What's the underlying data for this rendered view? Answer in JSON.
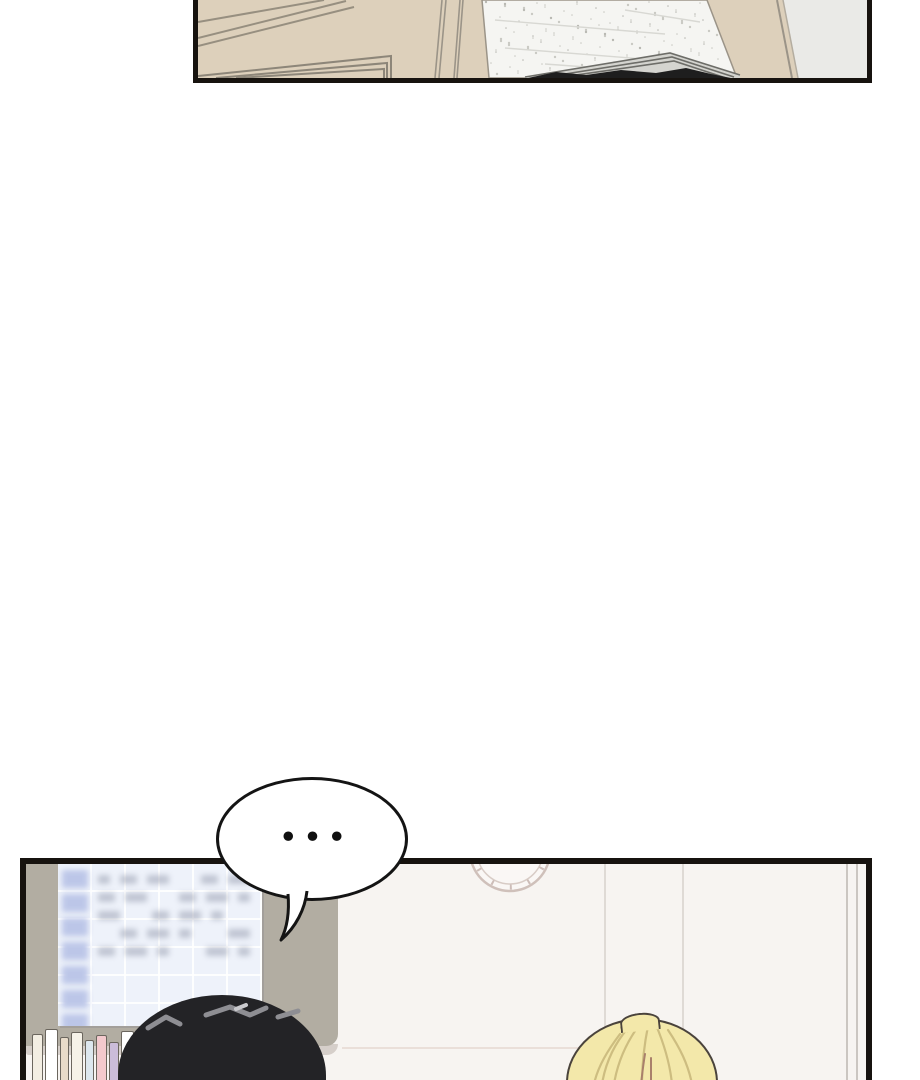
{
  "page": {
    "width": 920,
    "height": 1080,
    "kind": "webtoon-comic-page",
    "panel_count": 2
  },
  "speech_bubble": {
    "text": "•••",
    "shape": "ellipse",
    "tail_direction": "down-left"
  },
  "colors": {
    "page-bg": "#ffffff",
    "ink": "#17130f",
    "ink2": "#141414",
    "beige": "#ddd0bb",
    "ceiling-white": "#f5f5f2",
    "right-gray": "#eaeae7",
    "trim-line": "#978f80",
    "panel-bg": "#f7f4f1",
    "wall-gray": "#b2ada2",
    "tray": "#d6cfca",
    "board-bg": "#eef2fa",
    "board-header": "#bcc6e8",
    "dark-hair": "#232326",
    "dark-hair-highlight": "#8e8e93",
    "blonde": "#f3e8aa",
    "blonde-strand": "#cdbd80",
    "blonde-outline": "#4a433c",
    "clock-line": "#cfc0ba",
    "bubble-fill": "#ffffff",
    "faint-line": "#dfdad5",
    "frame-line": "#cbc6c1"
  },
  "top_panel": {
    "content": "beige ceiling corner with trim, speckled white ceiling section, beige pillar, gray wall"
  },
  "bottom_panel": {
    "content": "classroom wall: blurred timetable board on gray wall, wall clock, bookshelf spines, two heads",
    "board": {
      "header_cells": 7,
      "text_rows": 5,
      "text_cols": 6
    },
    "books": [
      {
        "x": 4,
        "w": 11,
        "h": 58,
        "c": "#f3eee3"
      },
      {
        "x": 17,
        "w": 13,
        "h": 63,
        "c": "#ffffff"
      },
      {
        "x": 32,
        "w": 9,
        "h": 55,
        "c": "#e8dbc9"
      },
      {
        "x": 43,
        "w": 12,
        "h": 60,
        "c": "#f6f2e8"
      },
      {
        "x": 57,
        "w": 9,
        "h": 52,
        "c": "#dde7ee"
      },
      {
        "x": 68,
        "w": 11,
        "h": 57,
        "c": "#f3c9cd"
      },
      {
        "x": 81,
        "w": 10,
        "h": 50,
        "c": "#cbbcd9"
      },
      {
        "x": 93,
        "w": 13,
        "h": 61,
        "c": "#ffffff"
      },
      {
        "x": 108,
        "w": 9,
        "h": 54,
        "c": "#cfe1eb"
      },
      {
        "x": 119,
        "w": 11,
        "h": 59,
        "c": "#f4eee0"
      },
      {
        "x": 132,
        "w": 9,
        "h": 51,
        "c": "#e9a9b0"
      },
      {
        "x": 143,
        "w": 12,
        "h": 63,
        "c": "#f7f4ec"
      },
      {
        "x": 157,
        "w": 9,
        "h": 53,
        "c": "#e9bcc2"
      },
      {
        "x": 168,
        "w": 11,
        "h": 58,
        "c": "#e6d9c6"
      },
      {
        "x": 181,
        "w": 10,
        "h": 50,
        "c": "#f0c6ca"
      },
      {
        "x": 193,
        "w": 12,
        "h": 60,
        "c": "#ffffff"
      },
      {
        "x": 207,
        "w": 9,
        "h": 54,
        "c": "#d5e3ec"
      },
      {
        "x": 218,
        "w": 11,
        "h": 57,
        "c": "#efe8d8"
      },
      {
        "x": 231,
        "w": 10,
        "h": 52,
        "c": "#c9b8d6"
      },
      {
        "x": 243,
        "w": 12,
        "h": 59,
        "c": "#f2efe6"
      },
      {
        "x": 257,
        "w": 10,
        "h": 55,
        "c": "#e2ebf1"
      },
      {
        "x": 269,
        "w": 11,
        "h": 60,
        "c": "#f5f1e9"
      }
    ]
  }
}
